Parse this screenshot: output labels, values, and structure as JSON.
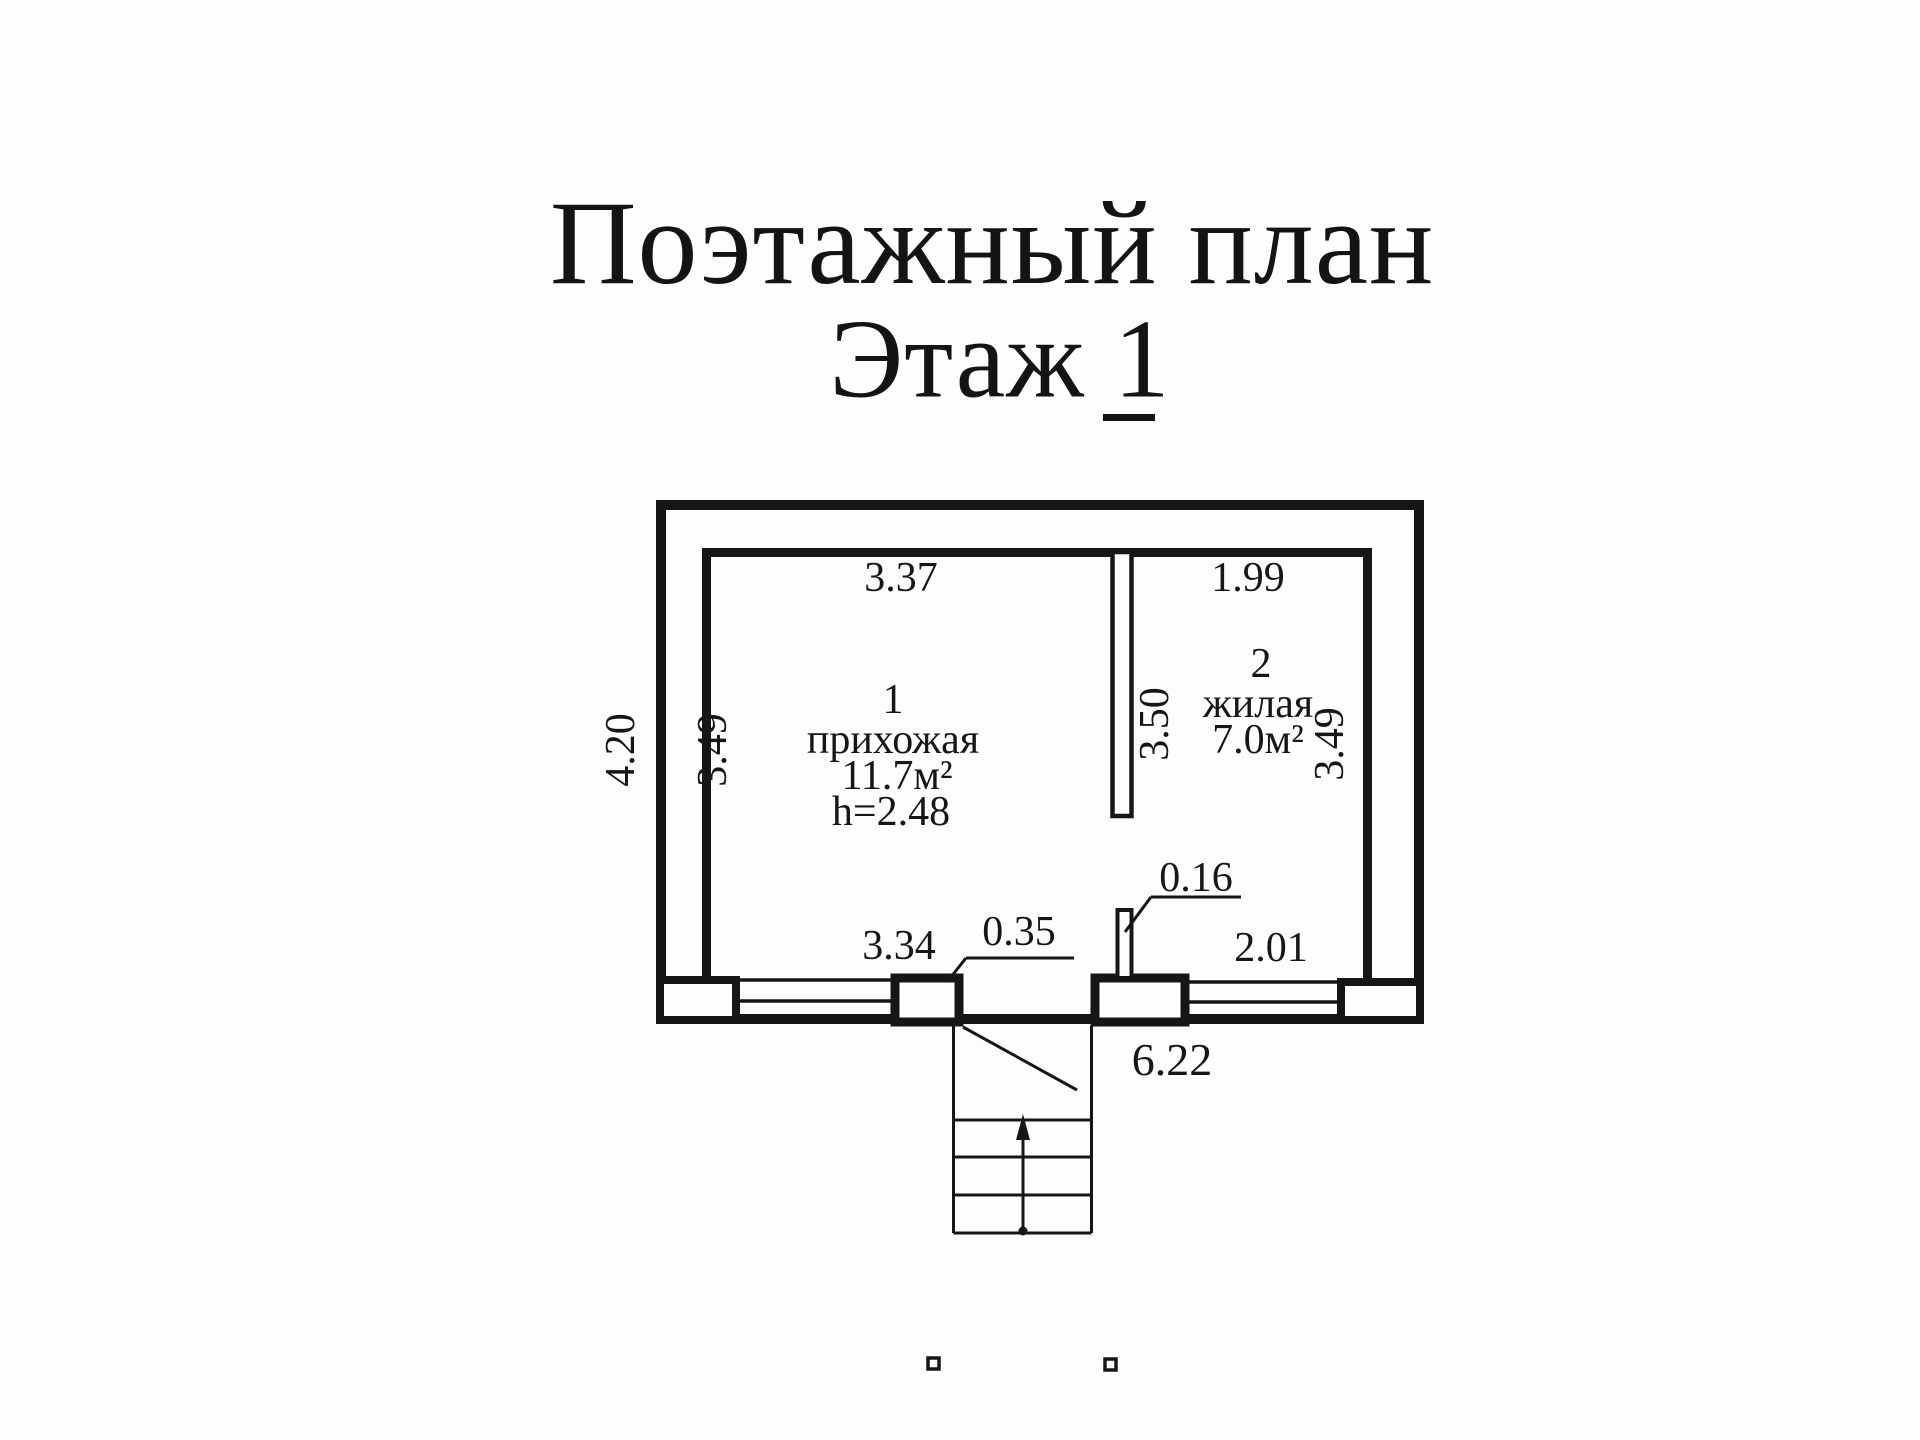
{
  "title": {
    "line1": "Поэтажный план",
    "line2": "Этаж 1"
  },
  "plan": {
    "dimensions": {
      "exterior_height_left": "4.20",
      "exterior_width_bottom": "6.22",
      "room1_width_top": "3.37",
      "room1_depth_left": "3.49",
      "room1_window_bottom": "3.34",
      "entrance_pier": "0.35",
      "wall_stub": "0.16",
      "room2_width_top": "1.99",
      "room2_depth_partition": "3.50",
      "room2_depth_right": "3.49",
      "room2_window_bottom": "2.01"
    },
    "rooms": [
      {
        "number": "1",
        "name": "прихожая",
        "area": "11.7м²",
        "ceiling_height": "h=2.48"
      },
      {
        "number": "2",
        "name": "жилая",
        "area": "7.0м²"
      }
    ]
  }
}
